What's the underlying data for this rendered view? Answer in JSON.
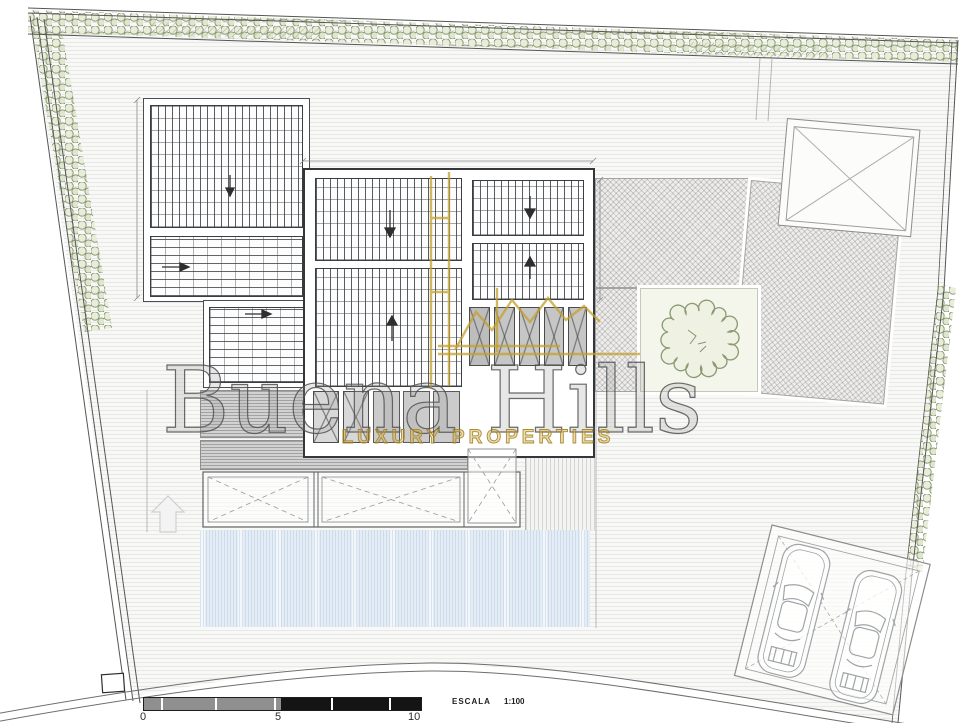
{
  "watermark": {
    "brand": "Buena Hills",
    "tagline": "LUXURY PROPERTIES",
    "brand_color": "#b8962e",
    "text_color": "#6b6b6b"
  },
  "scale_bar": {
    "label": "ESCALA",
    "ratio": "1:100",
    "ticks": [
      "0",
      "5",
      "10"
    ],
    "left_segment_color": "#8f8f8f",
    "right_segment_color": "#141414"
  },
  "colors": {
    "hedge_green": "#85956d",
    "pool_blue": "#e4edf6",
    "paving_gray": "#eeedec",
    "terrace_gray": "#d2d2d2",
    "line_dark": "#33373b",
    "gold": "#b8962e"
  }
}
